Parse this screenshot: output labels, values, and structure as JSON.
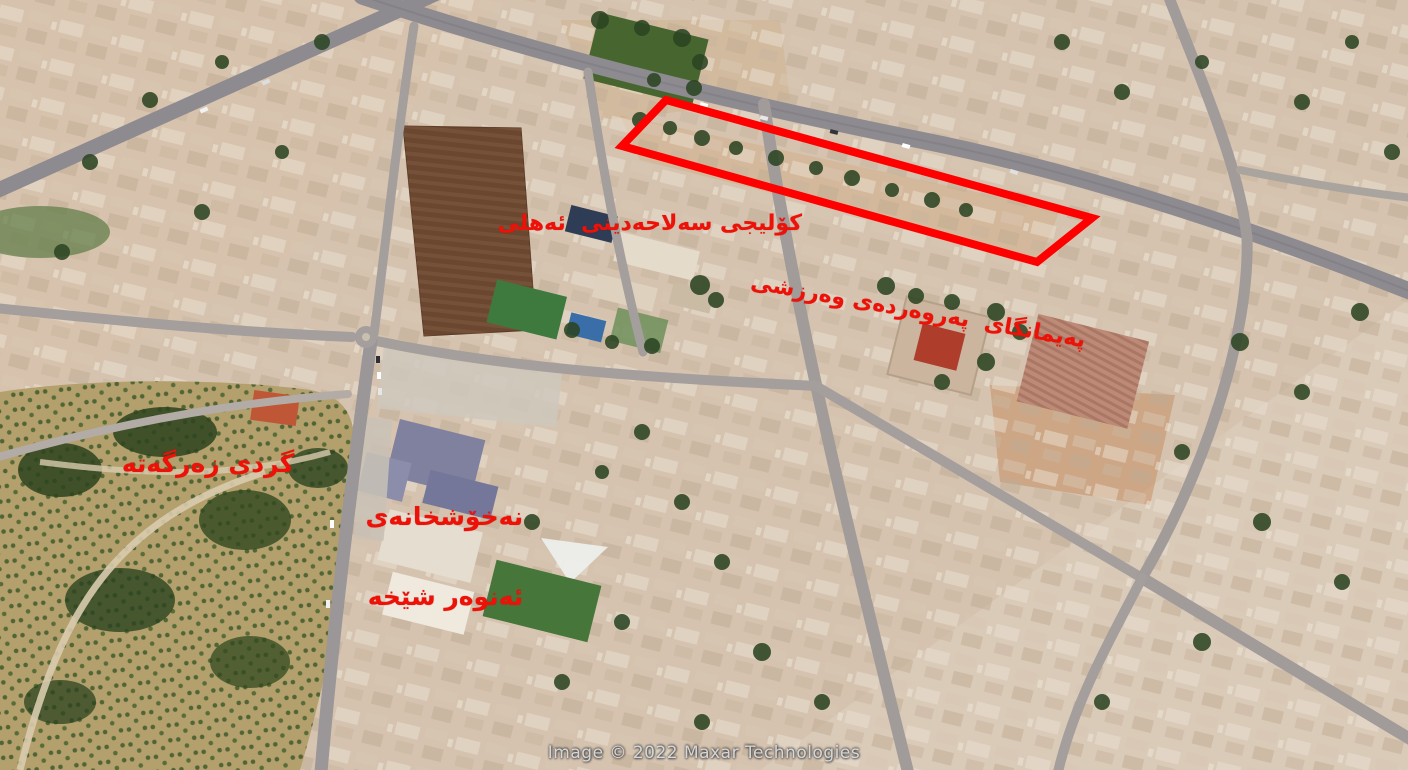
{
  "map": {
    "type": "satellite-aerial-view",
    "labels": {
      "college": {
        "text": "کۆلیجی سەلاحەدینی  ئەهلی"
      },
      "institute": {
        "text": "پەیمانگای  پەروەردەی وەرزشی"
      },
      "hill": {
        "text": "گردی زەرگەتە"
      },
      "hospital": {
        "line1": "نەخۆشخانەی",
        "line2": "ئەنوەر شێخە"
      }
    }
  },
  "overlay": {
    "highlight_polygon": {
      "points": "666,100 1092,218 1037,262 622,146",
      "stroke_width": "8"
    }
  },
  "watermark": {
    "text": "Image © 2022 Maxar Technologies"
  },
  "colors": {
    "label_red": "#ee1107",
    "highlight_red": "#ff0000",
    "ground_tan": "#d5c3b0",
    "road_gray": "#8d8a90",
    "vegetation_green": "#2c4523",
    "field_brown": "#6b4730",
    "watermark_gray": "#f0f0f0"
  }
}
